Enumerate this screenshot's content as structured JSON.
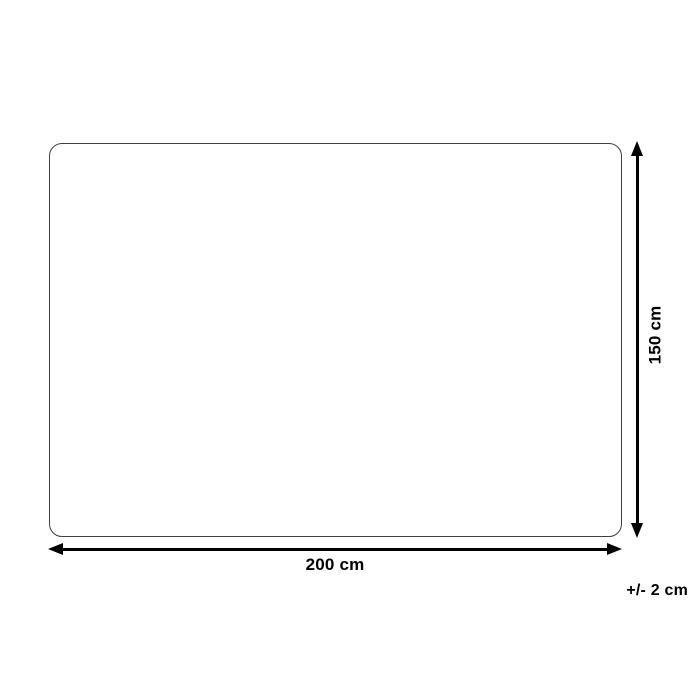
{
  "diagram": {
    "type": "product-dimension-diagram",
    "width_label": "200 cm",
    "height_label": "150 cm",
    "tolerance_label": "+/- 2 cm",
    "colors": {
      "background": "#ffffff",
      "outline": "#3f3f3f",
      "arrow": "#000000",
      "text": "#000000"
    }
  }
}
